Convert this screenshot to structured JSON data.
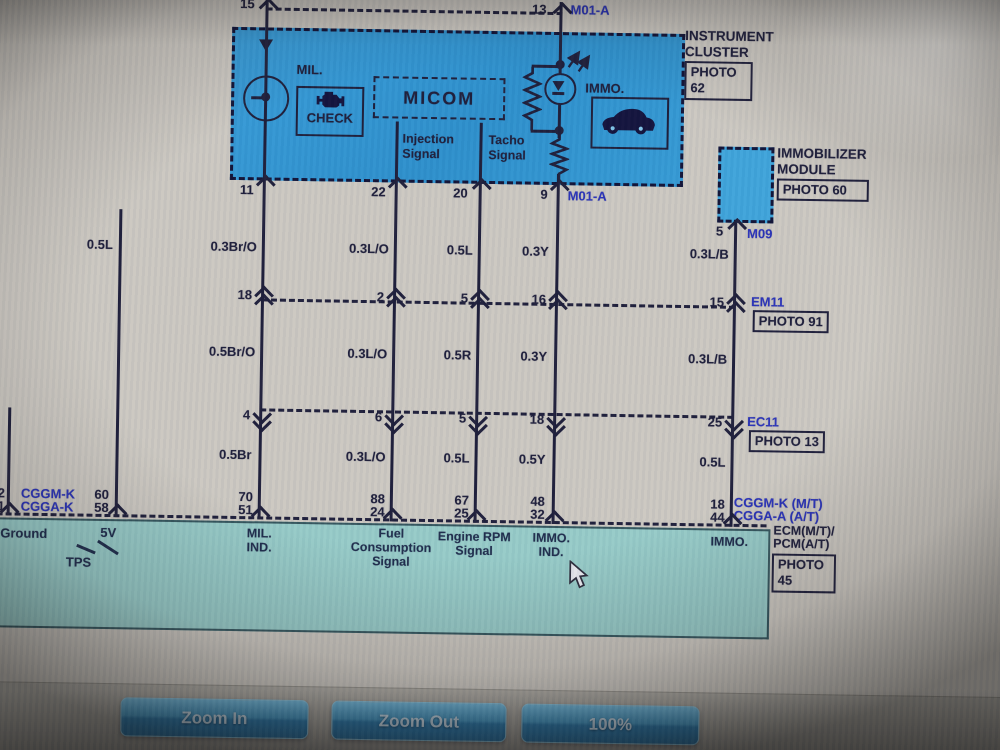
{
  "diagram": {
    "top": {
      "pin_left": "15",
      "pin_right": "13",
      "connector": "M01-A"
    },
    "cluster": {
      "name_line1": "INSTRUMENT",
      "name_line2": "CLUSTER",
      "photo_line1": "PHOTO",
      "photo_line2": "62",
      "mil_label": "MIL.",
      "check_label": "CHECK",
      "micom_label": "MICOM",
      "injection_line1": "Injection",
      "injection_line2": "Signal",
      "tacho_line1": "Tacho",
      "tacho_line2": "Signal",
      "immo_label": "IMMO.",
      "pins": {
        "mil": "11",
        "injection": "22",
        "tacho": "20",
        "immo": "9"
      },
      "connector": "M01-A"
    },
    "immob": {
      "name_line1": "IMMOBILIZER",
      "name_line2": "MODULE",
      "photo": "PHOTO 60",
      "pin": "5",
      "connector": "M09"
    },
    "wire_row1": [
      "0.5L",
      "0.3Br/O",
      "0.3L/O",
      "0.5L",
      "0.3Y",
      "0.3L/B"
    ],
    "em11": {
      "pins": [
        "18",
        "2",
        "5",
        "16",
        "15"
      ],
      "connector": "EM11",
      "photo": "PHOTO 91"
    },
    "wire_row2": [
      "0.5Br/O",
      "0.3L/O",
      "0.5R",
      "0.3Y",
      "0.3L/B"
    ],
    "ec11": {
      "pins": [
        "4",
        "6",
        "5",
        "18",
        "25"
      ],
      "connector": "EC11",
      "photo": "PHOTO 13"
    },
    "wire_row3": [
      "0.5Br",
      "0.3L/O",
      "0.5L",
      "0.5Y",
      "0.5L"
    ],
    "ecm": {
      "edge_top": "2",
      "edge_bottom": "61",
      "left_conn_top": "CGGM-K",
      "left_conn_bottom": "CGGA-K",
      "left_pin_top": "60",
      "left_pin_bottom": "58",
      "pairs": [
        [
          "70",
          "51"
        ],
        [
          "88",
          "24"
        ],
        [
          "67",
          "25"
        ],
        [
          "48",
          "32"
        ],
        [
          "18",
          "44"
        ]
      ],
      "right_conn_top": "CGGM-K (M/T)",
      "right_conn_bottom": "CGGA-A (A/T)"
    },
    "band": {
      "ground": "Ground",
      "five_v": "5V",
      "tps": "TPS",
      "mil_ind_line1": "MIL.",
      "mil_ind_line2": "IND.",
      "fuel_line1": "Fuel",
      "fuel_line2": "Consumption",
      "fuel_line3": "Signal",
      "rpm_line1": "Engine RPM",
      "rpm_line2": "Signal",
      "immo_ind_line1": "IMMO.",
      "immo_ind_line2": "IND.",
      "immo": "IMMO."
    },
    "ecm_label": {
      "line1": "ECM(M/T)/",
      "line2": "PCM(A/T)",
      "photo_line1": "PHOTO",
      "photo_line2": "45"
    }
  },
  "toolbar": {
    "zoom_in": "Zoom In",
    "zoom_out": "Zoom Out",
    "zoom_level": "100%"
  },
  "colors": {
    "cluster_fill": "#2e96d2",
    "ecm_fill": "#8ccac8",
    "label_blue": "#2730b8",
    "line_dark": "#1c1c38"
  }
}
